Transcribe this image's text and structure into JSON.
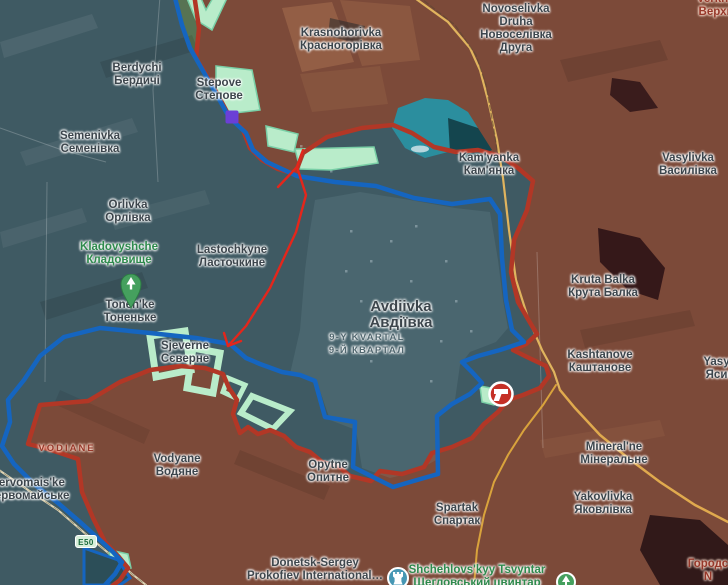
{
  "map": {
    "colors": {
      "ukraine_side": "#3f5a63",
      "russia_side": "#7c4a39",
      "frontline_blue": "#1565c0",
      "frontline_red": "#b23726",
      "advance_mint": "#b9ecca",
      "arrow_red": "#e4261b",
      "road_yellow": "#e0b45e",
      "water_teal": "#2b8e9e",
      "marker_purple": "#6b3fd6",
      "marker_combat_red": "#c53026",
      "pin_green": "#45a05e",
      "pin_blue": "#4797b4"
    },
    "road_badge": {
      "label": "E50"
    },
    "labels": [
      {
        "id": "krasnohorivka",
        "type": "town",
        "x": 341,
        "y": 27,
        "lines": [
          "Krasnohorivka",
          "Красногорівка"
        ]
      },
      {
        "id": "novoselivka-druha",
        "type": "town",
        "x": 516,
        "y": 3,
        "lines": [
          "Novoselivka",
          "Druha",
          "Новоселівка",
          "Друга"
        ]
      },
      {
        "id": "verkhn",
        "type": "district",
        "x": 716,
        "y": -7,
        "lines": [
          "Verkhn",
          "Верхн"
        ]
      },
      {
        "id": "berdychi",
        "type": "town",
        "x": 137,
        "y": 62,
        "lines": [
          "Berdychi",
          "Бердичі"
        ]
      },
      {
        "id": "stepove",
        "type": "town",
        "x": 219,
        "y": 77,
        "lines": [
          "Stepove",
          "Степове"
        ]
      },
      {
        "id": "semenivka",
        "type": "town",
        "x": 90,
        "y": 130,
        "lines": [
          "Semenivka",
          "Семенівка"
        ]
      },
      {
        "id": "kamyanka",
        "type": "town",
        "x": 489,
        "y": 152,
        "lines": [
          "Kam'yanka",
          "Кам'янка"
        ]
      },
      {
        "id": "vasylivka",
        "type": "town",
        "x": 688,
        "y": 152,
        "lines": [
          "Vasylivka",
          "Василівка"
        ]
      },
      {
        "id": "orlivka",
        "type": "town",
        "x": 128,
        "y": 199,
        "lines": [
          "Orlivka",
          "Орлівка"
        ]
      },
      {
        "id": "kladovyshche",
        "type": "green",
        "x": 119,
        "y": 241,
        "lines": [
          "Kladovyshche",
          "Кладовище"
        ]
      },
      {
        "id": "lastochkyne",
        "type": "town",
        "x": 232,
        "y": 244,
        "lines": [
          "Lastochkyne",
          "Ласточкине"
        ]
      },
      {
        "id": "tonenke",
        "type": "town",
        "x": 130,
        "y": 299,
        "lines": [
          "Tonen'ke",
          "Тоненьке"
        ]
      },
      {
        "id": "avdiivka",
        "type": "big",
        "x": 401,
        "y": 299,
        "lines": [
          "Avdiivka",
          "Авдіївка"
        ]
      },
      {
        "id": "kvartal-9",
        "type": "quarter",
        "x": 367,
        "y": 331,
        "lines": [
          "9-Y KVARTAL",
          "9-Й КВАРТАЛ"
        ]
      },
      {
        "id": "sjeverne",
        "type": "town",
        "x": 185,
        "y": 340,
        "lines": [
          "Sjeverne",
          "Сєверне"
        ]
      },
      {
        "id": "kruta-balka",
        "type": "town",
        "x": 603,
        "y": 274,
        "lines": [
          "Kruta Balka",
          "Крута Балка"
        ]
      },
      {
        "id": "kashtanove",
        "type": "town",
        "x": 600,
        "y": 349,
        "lines": [
          "Kashtanove",
          "Каштанове"
        ]
      },
      {
        "id": "yasynuvata",
        "type": "town",
        "x": 720,
        "y": 356,
        "lines": [
          "Yasyn",
          "Ясин"
        ]
      },
      {
        "id": "mineralne",
        "type": "town",
        "x": 614,
        "y": 441,
        "lines": [
          "Mineral'ne",
          "Мінеральне"
        ]
      },
      {
        "id": "yakovlivka",
        "type": "town",
        "x": 603,
        "y": 491,
        "lines": [
          "Yakovlivka",
          "Яковлівка"
        ]
      },
      {
        "id": "vodiane-district",
        "type": "district-caps",
        "x": 67,
        "y": 442,
        "lines": [
          "VODIANE"
        ]
      },
      {
        "id": "vodyane",
        "type": "town",
        "x": 177,
        "y": 453,
        "lines": [
          "Vodyane",
          "Водяне"
        ]
      },
      {
        "id": "pervomaiske",
        "type": "town",
        "x": 28,
        "y": 477,
        "lines": [
          "Pervomais'ke",
          "Первомайське"
        ]
      },
      {
        "id": "opytne",
        "type": "town",
        "x": 328,
        "y": 459,
        "lines": [
          "Opytne",
          "Опитне"
        ]
      },
      {
        "id": "spartak",
        "type": "town",
        "x": 457,
        "y": 502,
        "lines": [
          "Spartak",
          "Спартак"
        ]
      },
      {
        "id": "airport",
        "type": "poi",
        "x": 315,
        "y": 557,
        "lines": [
          "Donetsk-Sergey",
          "Prokofiev International…"
        ]
      },
      {
        "id": "shchehlovskyy-tsvyntar",
        "type": "green",
        "x": 477,
        "y": 564,
        "lines": [
          "Shchehlovs'kyy Tsvyntar",
          "Щегловський цвинтар"
        ]
      },
      {
        "id": "horods",
        "type": "district",
        "x": 708,
        "y": 558,
        "lines": [
          "Городс",
          "N"
        ]
      }
    ],
    "markers": [
      {
        "id": "combat-gun",
        "x": 486,
        "y": 379
      },
      {
        "id": "purple-square",
        "x": 232,
        "y": 117
      },
      {
        "id": "kladovyshche-pin",
        "x": 118,
        "y": 274
      },
      {
        "id": "airport-pin",
        "x": 385,
        "y": 565
      },
      {
        "id": "tsvyntar-pin",
        "x": 554,
        "y": 570
      }
    ]
  }
}
